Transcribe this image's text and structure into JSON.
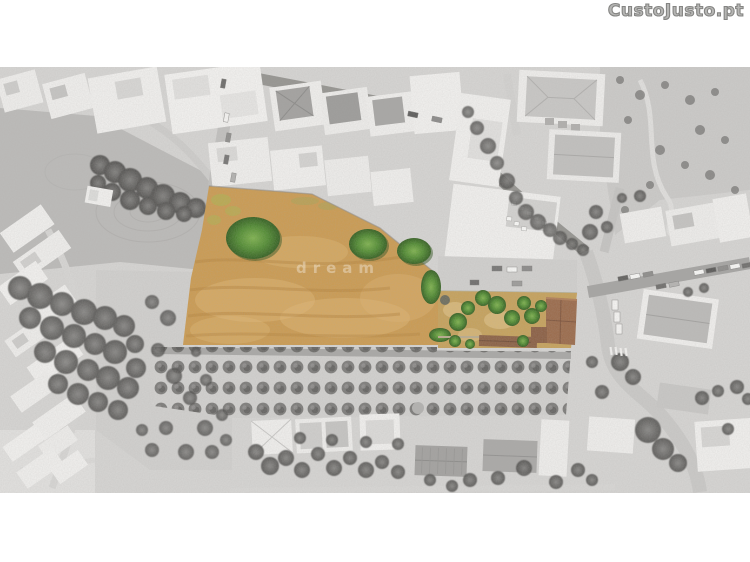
{
  "logo": {
    "text": "CustoJusto.pt",
    "color": "#9b9b99"
  },
  "watermark": {
    "text": "dream",
    "color": "rgba(255,255,255,0.34)"
  },
  "scene": {
    "type": "aerial-drone-photo-with-highlighted-parcel",
    "highlighted_parcel": {
      "label": "land-parcel-for-sale",
      "dry_field_color": "#d09a4f",
      "garden_ground_color": "#c9a35d",
      "tree_green_color": "#4e8a2e",
      "terracotta_roof_color": "#9a6847"
    },
    "surroundings": {
      "rendering": "grayscale",
      "base_color": "#d7d6d4",
      "features": [
        "town-buildings",
        "streets-with-parked-cars",
        "orchard-tree-rows",
        "plowed-field",
        "scrubland",
        "village-houses"
      ]
    }
  }
}
